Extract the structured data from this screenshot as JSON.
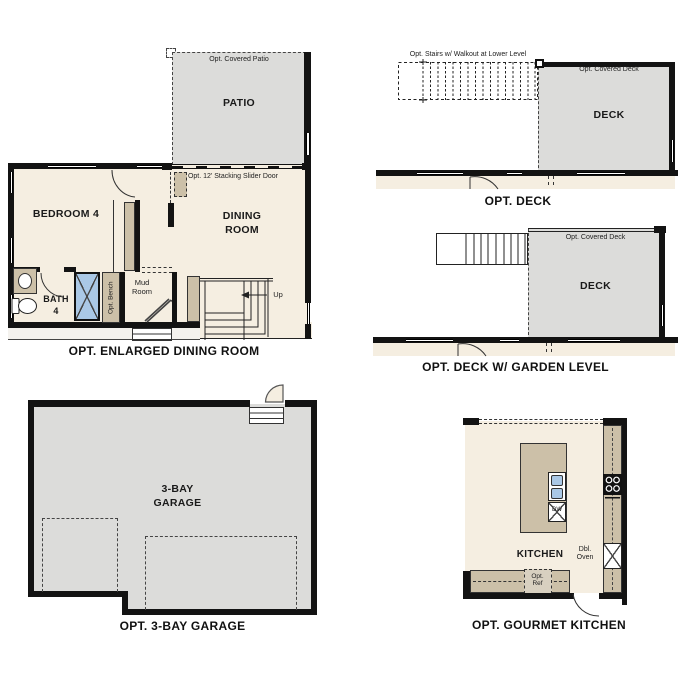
{
  "colors": {
    "wall": "#131313",
    "floor": "#f5eee1",
    "hardscape": "#dcdcda",
    "counter": "#ccc0a8",
    "shower_blue": "#aac8e6"
  },
  "plans": {
    "enlarged_dining": {
      "caption": "OPT. ENLARGED DINING ROOM",
      "patio_note": "Opt. Covered Patio",
      "patio_label": "PATIO",
      "slider_note": "Opt. 12' Stacking Slider Door",
      "bedroom_label": "BEDROOM 4",
      "dining_label": "DINING\nROOM",
      "bath_label": "BATH\n4",
      "bench_label": "Opt. Bench",
      "mud_label": "Mud\nRoom",
      "up_label": "Up"
    },
    "deck": {
      "caption": "OPT. DECK",
      "stairs_note": "Opt. Stairs w/ Walkout at Lower Level",
      "covered_note": "Opt. Covered Deck",
      "deck_label": "DECK"
    },
    "deck_garden": {
      "caption": "OPT. DECK W/ GARDEN LEVEL",
      "covered_note": "Opt. Covered Deck",
      "deck_label": "DECK"
    },
    "garage": {
      "caption": "OPT. 3-BAY GARAGE",
      "room_label": "3-BAY\nGARAGE"
    },
    "kitchen": {
      "caption": "OPT. GOURMET KITCHEN",
      "room_label": "KITCHEN",
      "dw_label": "DW",
      "oven_label": "Dbl.\nOven",
      "ref_label": "Opt.\nRef"
    }
  }
}
